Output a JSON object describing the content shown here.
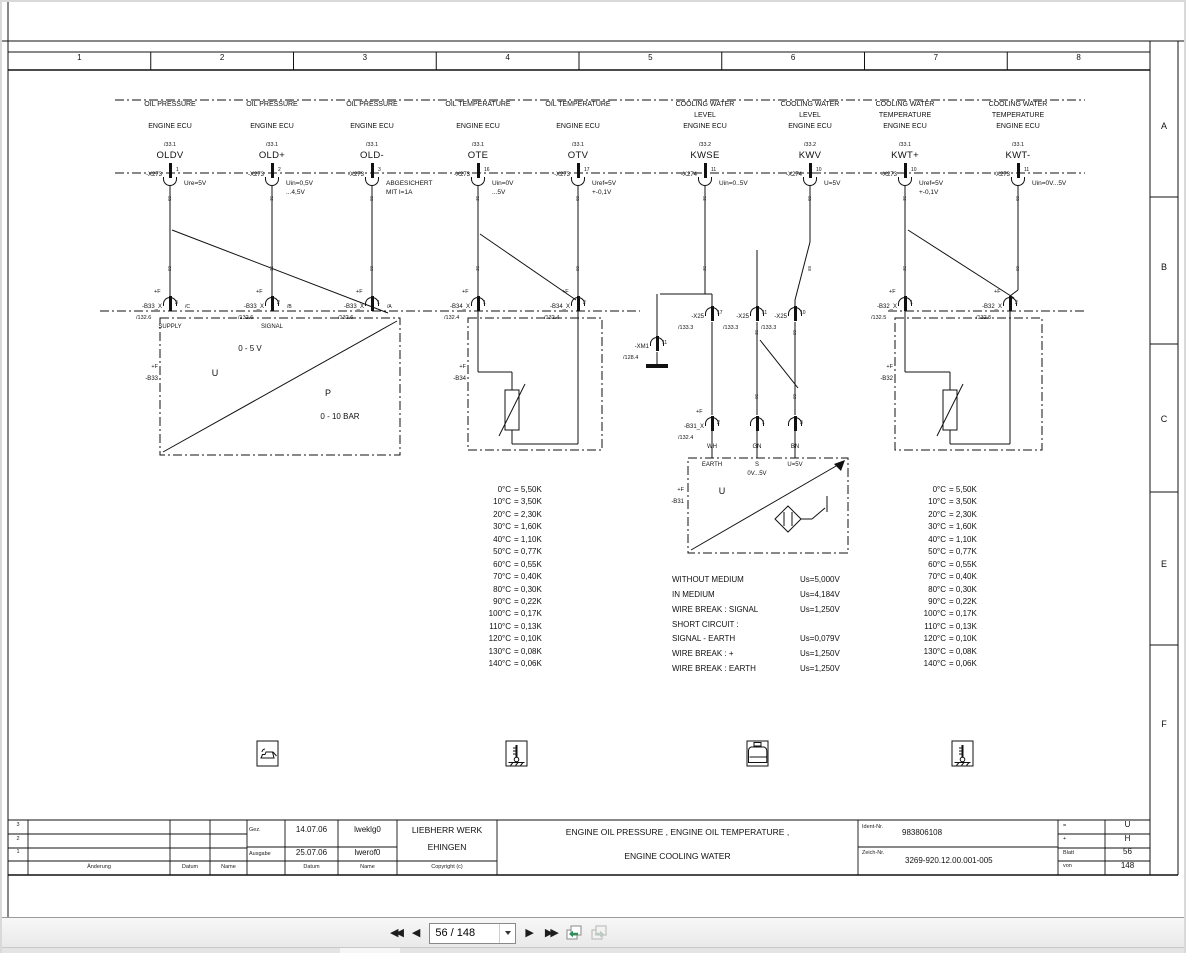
{
  "sheet": {
    "ruler": [
      "1",
      "2",
      "3",
      "4",
      "5",
      "6",
      "7",
      "8"
    ],
    "zones": [
      {
        "t": "A",
        "y": 127
      },
      {
        "t": "B",
        "y": 268
      },
      {
        "t": "C",
        "y": 420
      },
      {
        "t": "E",
        "y": 565
      },
      {
        "t": "F",
        "y": 725
      }
    ]
  },
  "labels": {
    "plusf": "+F"
  },
  "columns": [
    {
      "x": 170,
      "l1": "OIL PRESSURE",
      "l2": "",
      "ecu": "ENGINE ECU",
      "ref": "/33.1",
      "sig": "OLDV",
      "conn": "-X273",
      "pin": "1",
      "n1": "Ure=5V",
      "n2": "",
      "w": "85"
    },
    {
      "x": 272,
      "l1": "OIL PRESSURE",
      "l2": "",
      "ecu": "ENGINE ECU",
      "ref": "/33.1",
      "sig": "OLD+",
      "conn": "-X273",
      "pin": "2",
      "n1": "Uin=0,5V",
      "n2": "...4,5V",
      "w": "52"
    },
    {
      "x": 372,
      "l1": "OIL PRESSURE",
      "l2": "",
      "ecu": "ENGINE ECU",
      "ref": "/33.1",
      "sig": "OLD-",
      "conn": "-X273",
      "pin": "3",
      "n1": "ABGESICHERT",
      "n2": "MIT I=1A",
      "w": "88"
    },
    {
      "x": 478,
      "l1": "OIL TEMPERATURE",
      "l2": "",
      "ecu": "ENGINE ECU",
      "ref": "/33.1",
      "sig": "OTE",
      "conn": "-X273",
      "pin": "16",
      "n1": "Uin=0V",
      "n2": "...5V",
      "w": "52"
    },
    {
      "x": 578,
      "l1": "OIL TEMPERATURE",
      "l2": "",
      "ecu": "ENGINE ECU",
      "ref": "/33.1",
      "sig": "OTV",
      "conn": "-X273",
      "pin": "17",
      "n1": "Uref=5V",
      "n2": "+-0,1V",
      "w": "88"
    },
    {
      "x": 705,
      "l1": "COOLING WATER",
      "l2": "LEVEL",
      "ecu": "ENGINE ECU",
      "ref": "/33.2",
      "sig": "KWSE",
      "conn": "-X274",
      "pin": "11",
      "n1": "Uin=0..5V",
      "n2": "",
      "w": "52"
    },
    {
      "x": 810,
      "l1": "COOLING WATER",
      "l2": "LEVEL",
      "ecu": "ENGINE ECU",
      "ref": "/33.2",
      "sig": "KWV",
      "conn": "-X274",
      "pin": "10",
      "n1": "U=5V",
      "n2": "",
      "w": "88"
    },
    {
      "x": 905,
      "l1": "COOLING WATER",
      "l2": "TEMPERATURE",
      "ecu": "ENGINE ECU",
      "ref": "/33.1",
      "sig": "KWT+",
      "conn": "-X273",
      "pin": "10",
      "n1": "Uref=5V",
      "n2": "+-0,1V",
      "w": "52"
    },
    {
      "x": 1018,
      "l1": "COOLING WATER",
      "l2": "TEMPERATURE",
      "ecu": "ENGINE ECU",
      "ref": "/33.1",
      "sig": "KWT-",
      "conn": "-X273",
      "pin": "11",
      "n1": "Uin=0V...5V",
      "n2": "",
      "w": "88"
    }
  ],
  "pins": {
    "b33": [
      {
        "x": 170,
        "name": "-B33_X",
        "pin": "3",
        "tag": "/C",
        "ref": "/132.6",
        "sub": "SUPPLY",
        "pf": true
      },
      {
        "x": 272,
        "name": "-B33_X",
        "pin": "2",
        "tag": "/B",
        "ref": "/132.6",
        "sub": "SIGNAL",
        "pf": true
      },
      {
        "x": 372,
        "name": "-B33_X",
        "pin": "1",
        "tag": "/A",
        "ref": "/132.6",
        "sub": "",
        "pf": true
      }
    ],
    "b34": [
      {
        "x": 478,
        "name": "-B34_X",
        "pin": "1",
        "tag": "",
        "ref": "/132.4",
        "sub": "",
        "pf": true
      },
      {
        "x": 578,
        "name": "-B34_X",
        "pin": "2",
        "tag": "",
        "ref": "/132.4",
        "sub": "",
        "pf": true
      }
    ],
    "x25": [
      {
        "x": 712,
        "name": "-X25",
        "pin": "17",
        "tag": "",
        "ref": "/133.3",
        "sub": "",
        "pf": false
      },
      {
        "x": 757,
        "name": "-X25",
        "pin": "11",
        "tag": "",
        "ref": "/133.3",
        "sub": "",
        "pf": false
      },
      {
        "x": 795,
        "name": "-X25",
        "pin": "10",
        "tag": "",
        "ref": "/133.3",
        "sub": "",
        "pf": false
      }
    ],
    "xm1": [
      {
        "x": 657,
        "name": "-XM1",
        "pin": "11",
        "tag": "",
        "ref": "/128.4",
        "sub": "",
        "pf": false
      }
    ],
    "b31": [
      {
        "x": 712,
        "name": "-B31_X",
        "pin": "2",
        "tag": "",
        "ref": "/132.4",
        "sub": "WH",
        "pf": true
      },
      {
        "x": 757,
        "name": "",
        "pin": "1",
        "tag": "",
        "ref": "",
        "sub": "GN",
        "pf": false
      },
      {
        "x": 795,
        "name": "",
        "pin": "3",
        "tag": "",
        "ref": "",
        "sub": "BN",
        "pf": false
      }
    ],
    "b32": [
      {
        "x": 905,
        "name": "-B32_X",
        "pin": "1",
        "tag": "",
        "ref": "/132.5",
        "sub": "",
        "pf": true
      },
      {
        "x": 1010,
        "name": "-B32_X",
        "pin": "2",
        "tag": "",
        "ref": "/132.5",
        "sub": "",
        "pf": true
      }
    ]
  },
  "mid_wires": [
    "52",
    "88",
    "50",
    "88"
  ],
  "sensors": {
    "b33": {
      "plusf": "+F",
      "name": "-B33",
      "range_v": "0 - 5 V",
      "u": "U",
      "p": "P",
      "range_p": "0 - 10 BAR"
    },
    "b34": {
      "plusf": "+F",
      "name": "-B34"
    },
    "b31": {
      "plusf": "+F",
      "name": "-B31",
      "earth": "EARTH",
      "s": "S",
      "srange": "0V...5V",
      "u5": "U=5V",
      "u": "U"
    },
    "b32": {
      "plusf": "+F",
      "name": "-B32"
    }
  },
  "temp_table": [
    {
      "t": "0°C",
      "v": "= 5,50K"
    },
    {
      "t": "10°C",
      "v": "= 3,50K"
    },
    {
      "t": "20°C",
      "v": "= 2,30K"
    },
    {
      "t": "30°C",
      "v": "= 1,60K"
    },
    {
      "t": "40°C",
      "v": "= 1,10K"
    },
    {
      "t": "50°C",
      "v": "= 0,77K"
    },
    {
      "t": "60°C",
      "v": "= 0,55K"
    },
    {
      "t": "70°C",
      "v": "= 0,40K"
    },
    {
      "t": "80°C",
      "v": "= 0,30K"
    },
    {
      "t": "90°C",
      "v": "= 0,22K"
    },
    {
      "t": "100°C",
      "v": "= 0,17K"
    },
    {
      "t": "110°C",
      "v": "= 0,13K"
    },
    {
      "t": "120°C",
      "v": "= 0,10K"
    },
    {
      "t": "130°C",
      "v": "= 0,08K"
    },
    {
      "t": "140°C",
      "v": "= 0,06K"
    }
  ],
  "conditions": [
    {
      "l": "WITHOUT MEDIUM",
      "v": "Us=5,000V"
    },
    {
      "l": "IN MEDIUM",
      "v": "Us=4,184V"
    },
    {
      "l": "WIRE BREAK : SIGNAL",
      "v": "Us=1,250V"
    },
    {
      "l": "SHORT CIRCUIT :",
      "v": ""
    },
    {
      "l": "SIGNAL - EARTH",
      "v": "Us=0,079V"
    },
    {
      "l": "WIRE BREAK : +",
      "v": "Us=1,250V"
    },
    {
      "l": "WIRE BREAK : EARTH",
      "v": "Us=1,250V"
    }
  ],
  "icons": {
    "i1": "oil-pressure-icon",
    "i2": "oil-temperature-icon",
    "i3": "coolant-level-icon",
    "i4": "coolant-temperature-icon"
  },
  "title_block": {
    "rev_rows": [
      "3",
      "2",
      "1"
    ],
    "aenderung": "Änderung",
    "datum": "Datum",
    "name": "Name",
    "gez_label": "Gez.",
    "gez_date": "14.07.06",
    "gez_name": "lweklg0",
    "ausgabe_label": "Ausgabe",
    "ausgabe_date": "25.07.06",
    "ausgabe_name": "lwerof0",
    "datum2": "Datum",
    "name2": "Name",
    "copyright": "Copyright (c)",
    "company1": "LIEBHERR WERK",
    "company2": "EHINGEN",
    "title1": "ENGINE OIL PRESSURE , ENGINE OIL TEMPERATURE ,",
    "title2": "ENGINE COOLING WATER",
    "ident_label": "Ident-Nr.",
    "ident": "983806108",
    "zeich_label": "Zeich-Nr.",
    "zeich": "3269-920.12.00.001-005",
    "mini": [
      {
        "k": "=",
        "v": "U"
      },
      {
        "k": "+",
        "v": "H"
      },
      {
        "k": "Blatt",
        "v": "56"
      },
      {
        "k": "von",
        "v": "148"
      }
    ]
  },
  "toolbar": {
    "first": "◀◀",
    "prev": "◀",
    "page": "56 / 148",
    "next": "▶",
    "last": "▶▶"
  }
}
